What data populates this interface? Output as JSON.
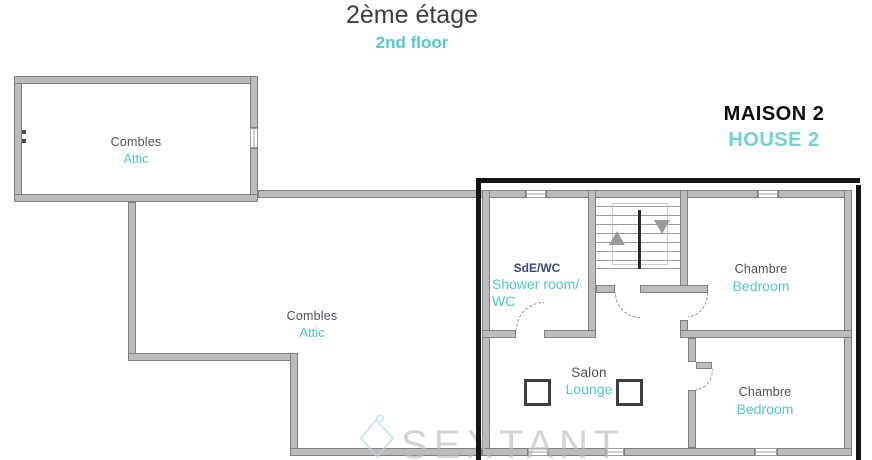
{
  "page": {
    "title_fr": "2ème étage",
    "title_en": "2nd floor"
  },
  "house": {
    "label_fr": "MAISON 2",
    "label_en": "HOUSE 2"
  },
  "rooms": {
    "attic_small": {
      "fr": "Combles",
      "en": "Attic"
    },
    "attic_large": {
      "fr": "Combles",
      "en": "Attic"
    },
    "shower_wc": {
      "fr": "SdE/WC",
      "en_line1": "Shower room/",
      "en_line2": "WC"
    },
    "bedroom_top": {
      "fr": "Chambre",
      "en": "Bedroom"
    },
    "bedroom_bottom": {
      "fr": "Chambre",
      "en": "Bedroom"
    },
    "lounge": {
      "fr": "Salon",
      "en": "Lounge"
    }
  },
  "stairs": {
    "up_icon": "triangle-up",
    "down_icon": "triangle-down"
  },
  "watermark": {
    "brand": "SEXTANT",
    "logo_icon": "sextant-diamond-logo"
  },
  "colors": {
    "french_label": "#4d4f5e",
    "french_label_blue": "#3e4a86",
    "english_label": "#4fc6cf",
    "title_french": "#3e3e3e",
    "title_english": "#55c8ce",
    "house_french": "#0b0b0b",
    "house_english": "#70d1d7",
    "wall_fill": "#bcbcbc",
    "wall_edge": "#7f7f7f",
    "house_frame": "#141414",
    "watermark_text": "#b9b9b9",
    "watermark_logo": "#b2dfe3"
  }
}
